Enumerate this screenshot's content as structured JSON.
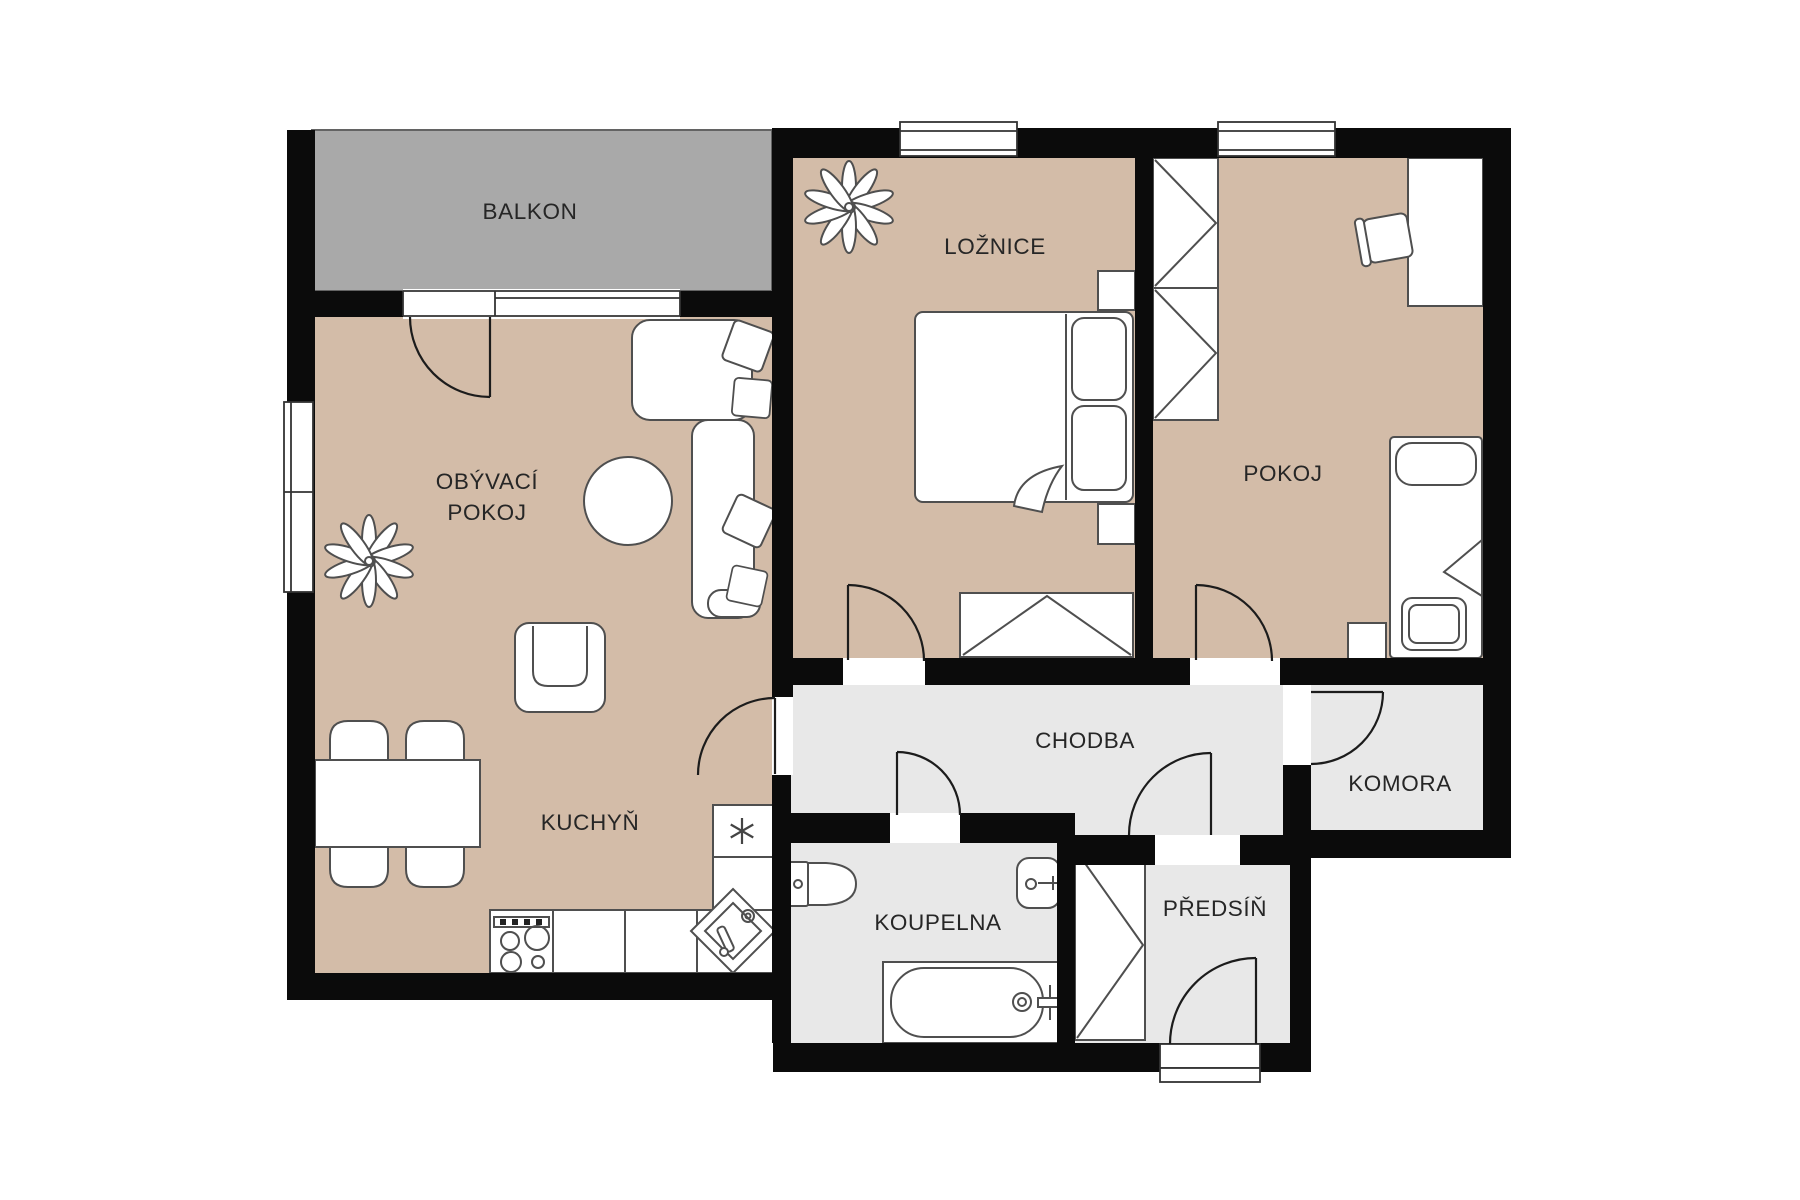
{
  "rooms": {
    "balkon": {
      "label": "BALKON"
    },
    "obyvaci_pokoj": {
      "label_line1": "OBÝVACÍ",
      "label_line2": "POKOJ"
    },
    "kuchyn": {
      "label": "KUCHYŇ"
    },
    "loznice": {
      "label": "LOŽNICE"
    },
    "pokoj": {
      "label": "POKOJ"
    },
    "chodba": {
      "label": "CHODBA"
    },
    "komora": {
      "label": "KOMORA"
    },
    "koupelna": {
      "label": "KOUPELNA"
    },
    "predsin": {
      "label": "PŘEDSÍŇ"
    }
  },
  "colors": {
    "wall": "#0b0b0b",
    "room_floor": "#d3bca8",
    "utility_floor": "#e8e8e8",
    "balcony_floor": "#a9a9a9",
    "furniture_outline": "#4f4f4f",
    "door_stroke": "#1c1c1c",
    "label_text": "#262626"
  }
}
